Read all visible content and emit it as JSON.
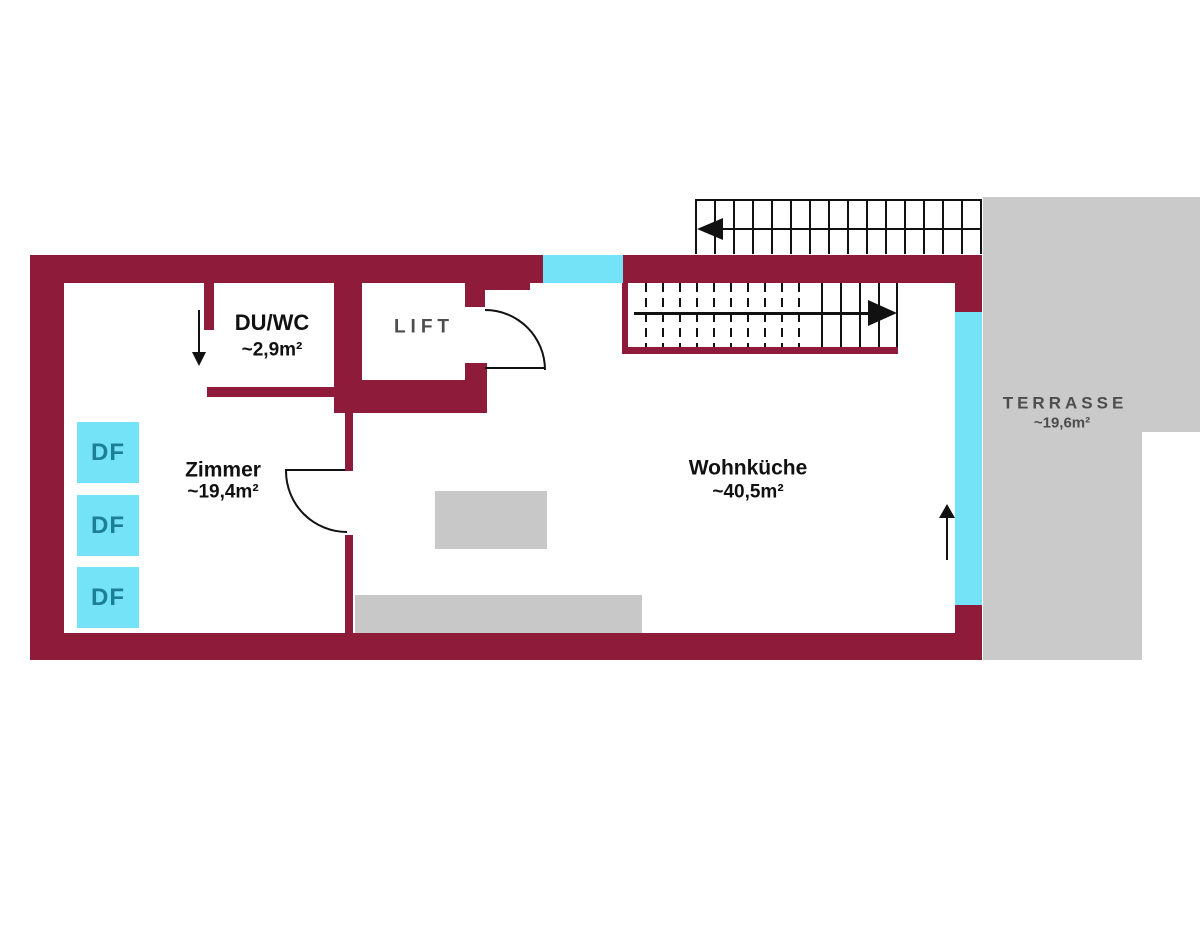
{
  "plan": {
    "rooms": {
      "zimmer": {
        "name": "Zimmer",
        "area": "~19,4m²"
      },
      "duwc": {
        "name": "DU/WC",
        "area": "~2,9m²"
      },
      "wohnkueche": {
        "name": "Wohnküche",
        "area": "~40,5m²"
      },
      "lift": {
        "name": "LIFT"
      },
      "terrasse": {
        "name": "TERRASSE",
        "area": "~19,6m²"
      }
    },
    "window_label": "DF",
    "colors": {
      "wall": "#8e1b3a",
      "glass": "#74e3f7",
      "terrace": "#cacaca",
      "furniture": "#c8c8c8",
      "df_text": "#1d7f96",
      "label_dark": "#111111",
      "label_muted": "#4d4d4d",
      "line": "#111111"
    }
  }
}
